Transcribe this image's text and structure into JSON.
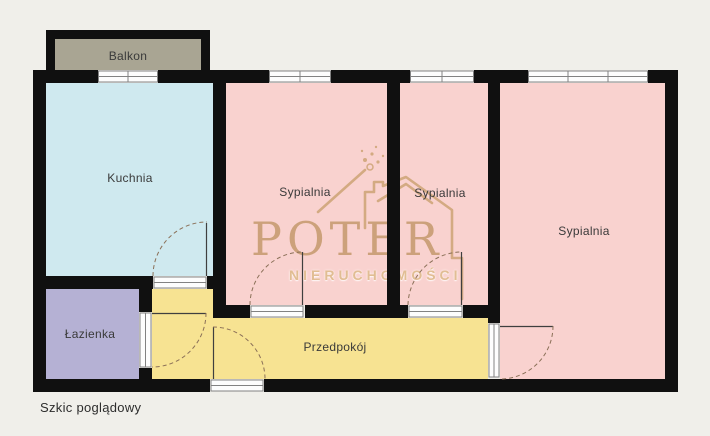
{
  "page": {
    "footnote": "Szkic poglądowy"
  },
  "watermark": {
    "brand": "POTER",
    "subtitle": "NIERUCHOMOŚCI"
  },
  "plan": {
    "colors": {
      "background": "#f0efea",
      "wall": "#101010",
      "balcony": "#a9a593",
      "kitchen": "#cfe9ef",
      "bedroom": "#f9d2cf",
      "bathroom": "#b5b1d4",
      "hallway": "#f7e392",
      "watermark_tan": "#c89c72",
      "watermark_light": "#e0bc90"
    },
    "rooms": {
      "balkon": {
        "label": "Balkon"
      },
      "kuchnia": {
        "label": "Kuchnia"
      },
      "sypialnia1": {
        "label": "Sypialnia"
      },
      "sypialnia2": {
        "label": "Sypialnia"
      },
      "sypialnia3": {
        "label": "Sypialnia"
      },
      "lazienka": {
        "label": "Łazienka"
      },
      "przedpokoj": {
        "label": "Przedpokój"
      }
    }
  }
}
